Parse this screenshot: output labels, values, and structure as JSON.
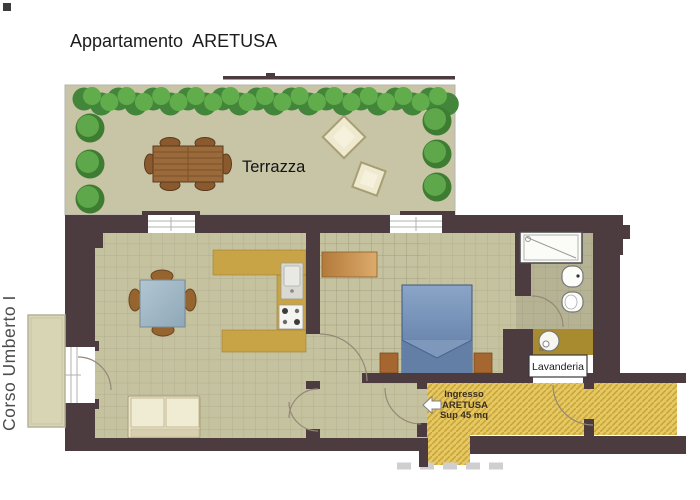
{
  "title": "Appartamento  ARETUSA",
  "street": {
    "label": "Corso Umberto I"
  },
  "terrace": {
    "label": "Terrazza"
  },
  "entrance": {
    "line1": "Ingresso",
    "line2": "ARETUSA",
    "line3": "Sup 45 mq"
  },
  "laundry": {
    "label": "Lavanderia"
  },
  "colors": {
    "wall": "#4c3c40",
    "room_floor": "#c5c2a0",
    "terrace_floor": "#c8c5a7",
    "bathroom_floor": "#b6b394",
    "kitchen_counter": "#c9a447",
    "laundry_floor": "#a98b2f",
    "corridor_fill": "#e6c860",
    "corridor_hatch": "#c9a53e",
    "bed_blue": "#6d8cb4",
    "wood_brown": "#9a6a3a",
    "hedge_green": "#55a243",
    "sofa_cream": "#eae4ca"
  }
}
